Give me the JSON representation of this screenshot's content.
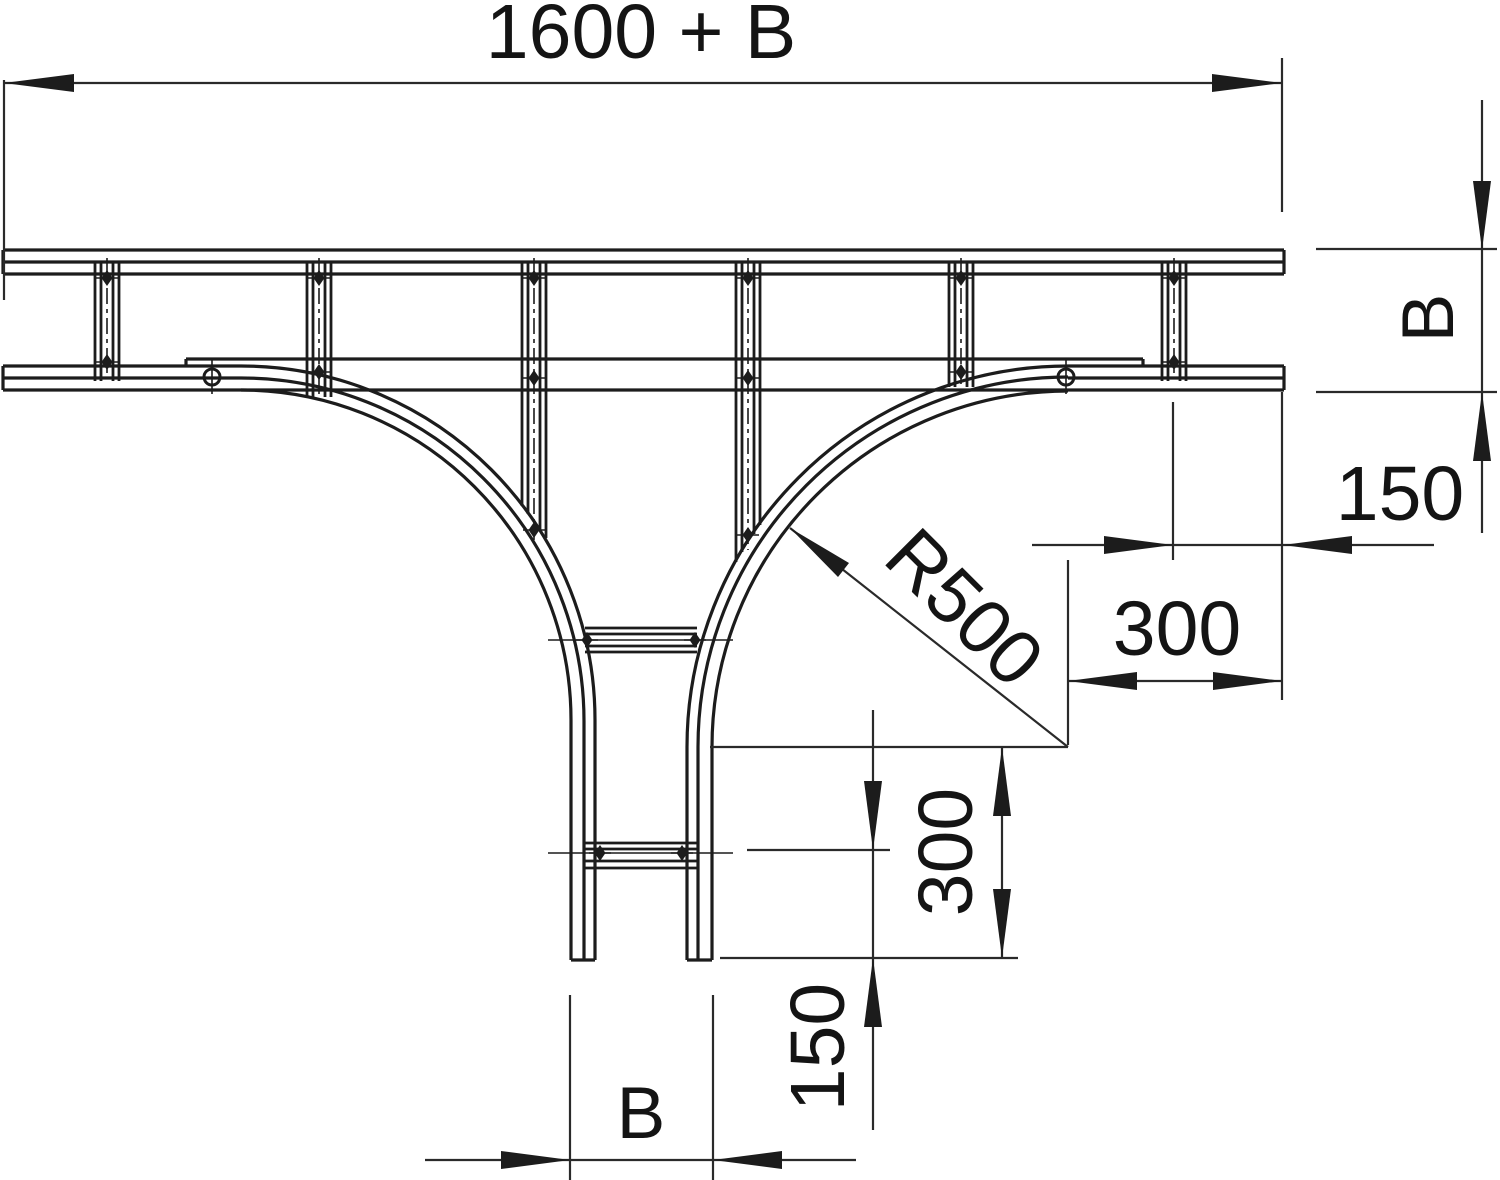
{
  "drawing": {
    "type": "technical-dimension-drawing",
    "subject": "cable ladder T-piece, plan view",
    "colors": {
      "background": "#ffffff",
      "line": "#1c1c1c",
      "text": "#141414"
    },
    "dims": {
      "total_length": "1600 + B",
      "width_right": "B",
      "end_distance_right": "150",
      "corner_horizontal": "300",
      "radius": "R500",
      "corner_vertical": "300",
      "end_distance_bottom": "150",
      "width_bottom": "B"
    }
  }
}
